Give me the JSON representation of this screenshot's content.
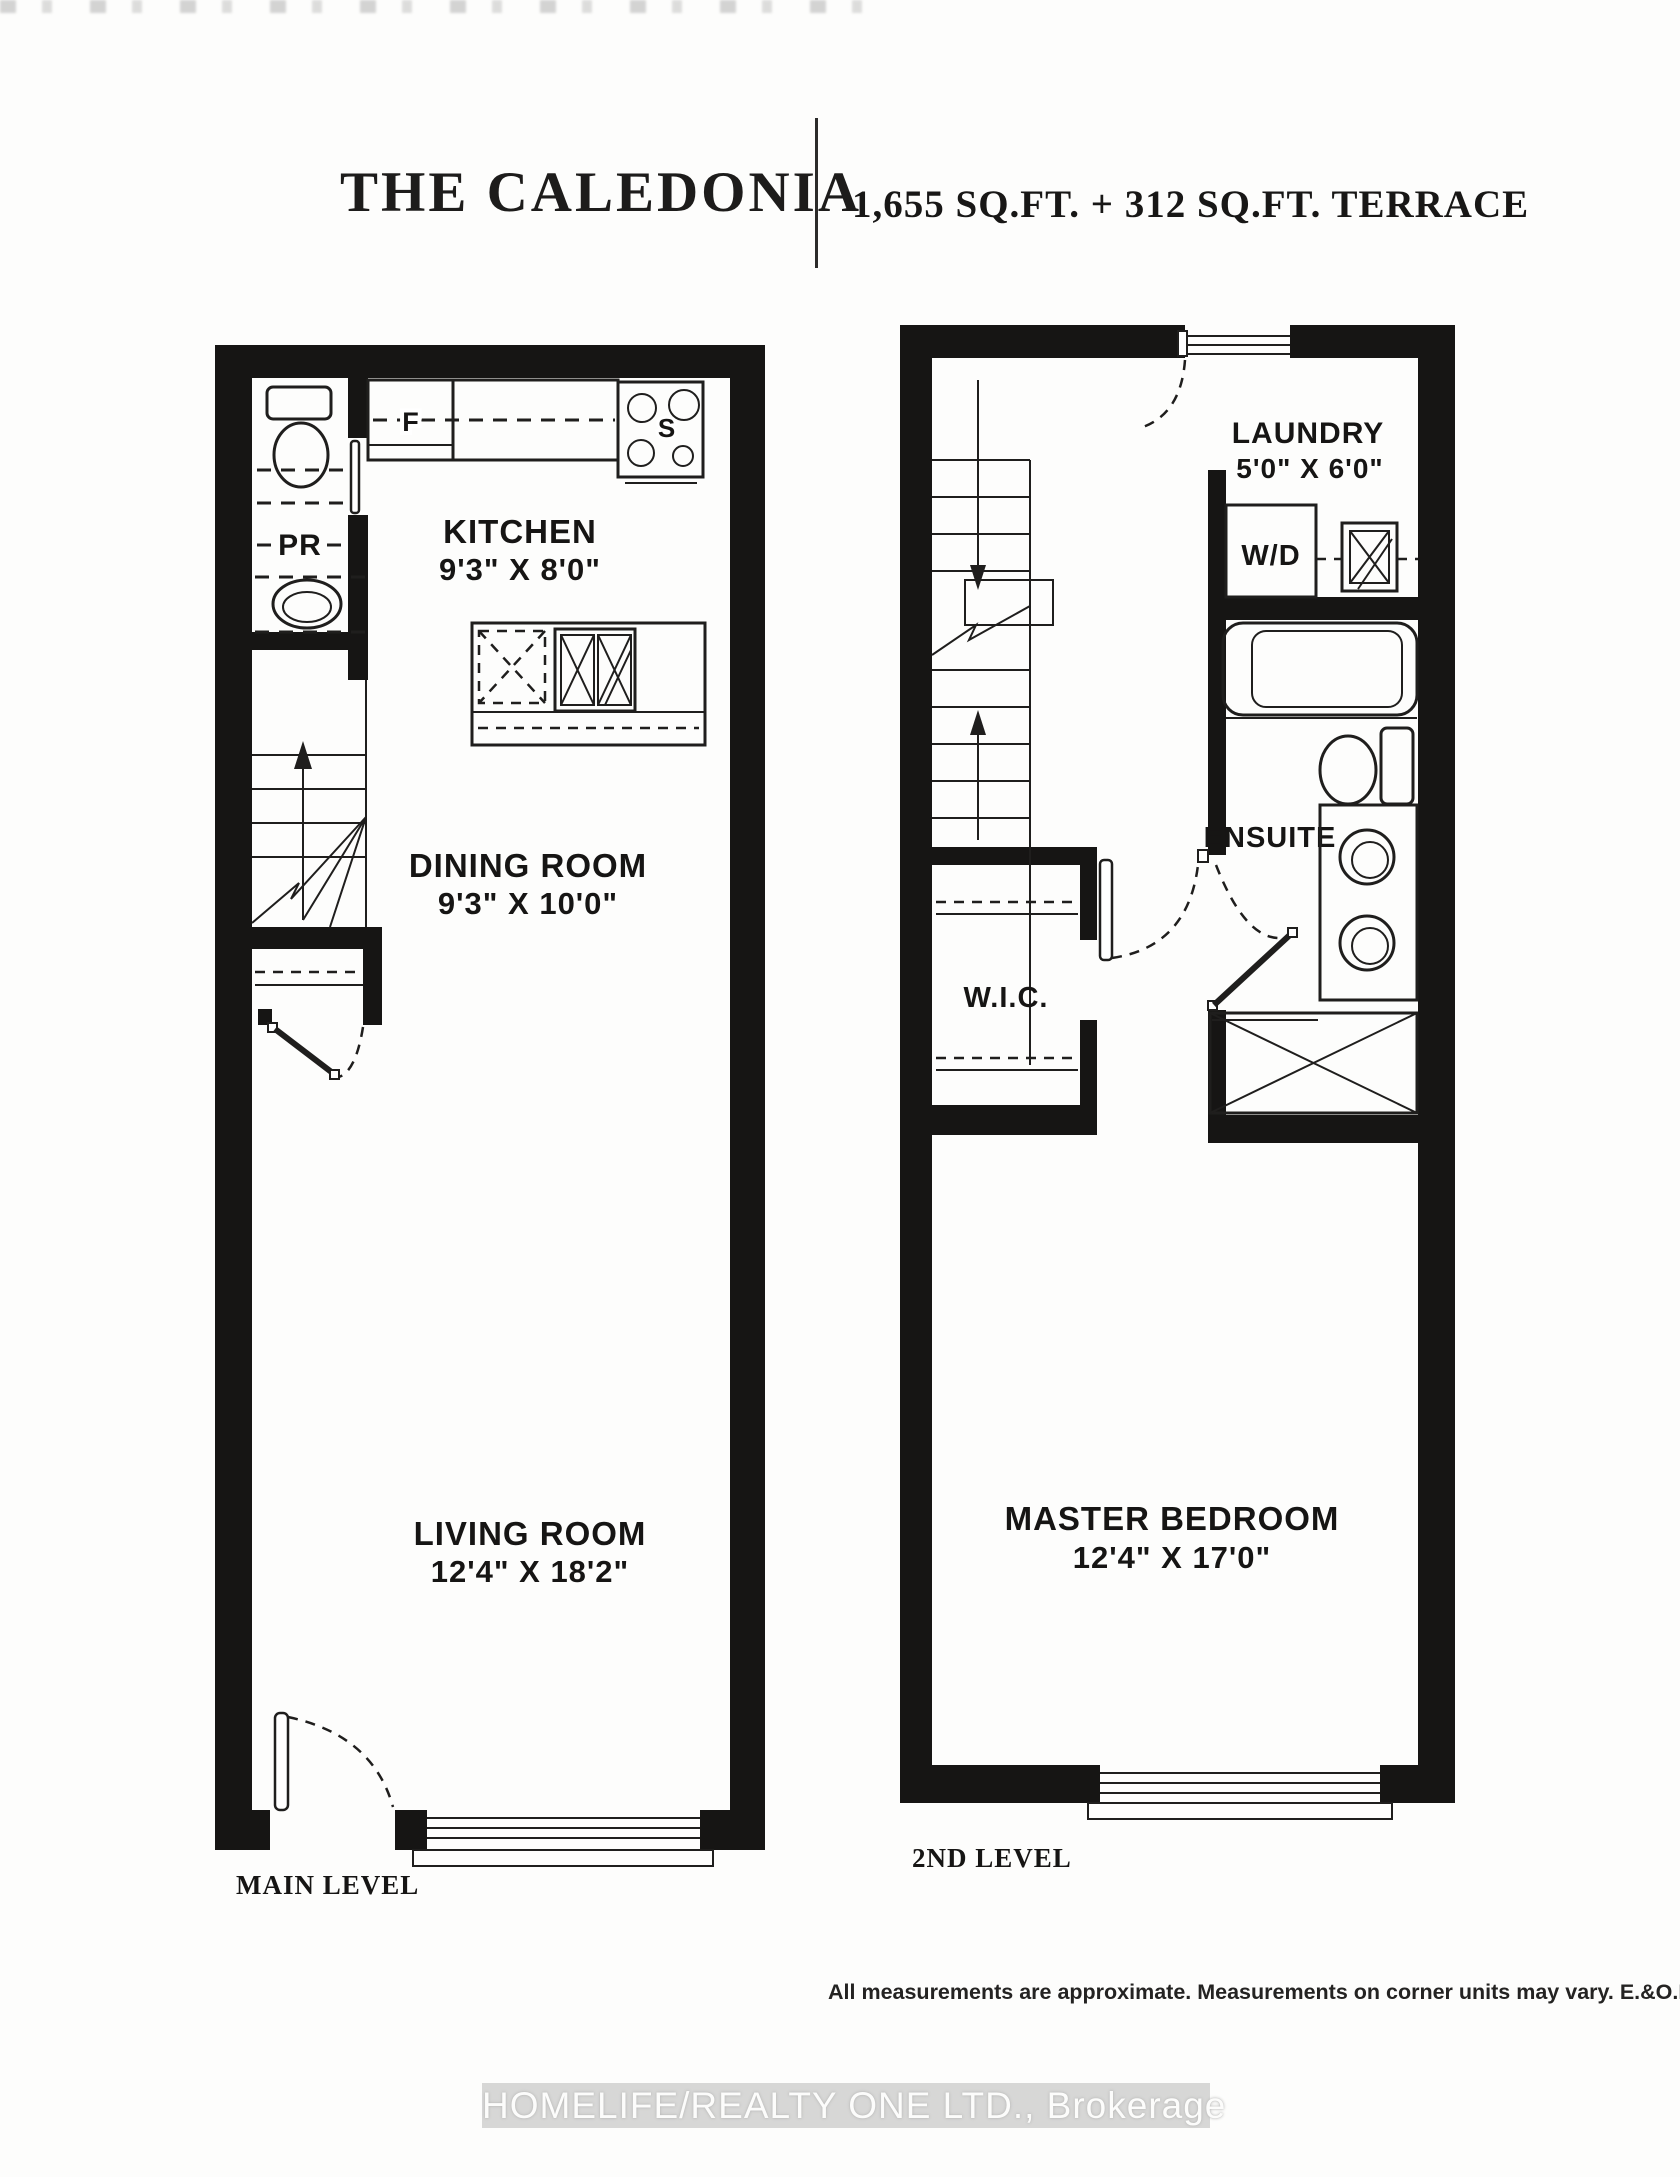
{
  "header": {
    "title": "THE CALEDONIA",
    "area_text": "1,655 SQ.FT. + 312 SQ.FT. TERRACE"
  },
  "main_level": {
    "level_label": "MAIN LEVEL",
    "rooms": {
      "kitchen": {
        "name": "KITCHEN",
        "dims": "9'3\" X 8'0\""
      },
      "dining": {
        "name": "DINING ROOM",
        "dims": "9'3\" X 10'0\""
      },
      "living": {
        "name": "LIVING ROOM",
        "dims": "12'4\" X 18'2\""
      },
      "powder": {
        "label": "PR"
      }
    },
    "fixtures": {
      "fridge_label": "F",
      "stove_label": "S"
    }
  },
  "second_level": {
    "level_label": "2ND LEVEL",
    "rooms": {
      "laundry": {
        "name": "LAUNDRY",
        "dims": "5'0\" X 6'0\""
      },
      "ensuite": {
        "name": "ENSUITE"
      },
      "wic": {
        "label": "W.I.C."
      },
      "master": {
        "name": "MASTER BEDROOM",
        "dims": "12'4\" X 17'0\""
      }
    },
    "fixtures": {
      "washer_dryer_label": "W/D"
    }
  },
  "footer": {
    "disclaimer": "All measurements are approximate. Measurements on corner units may vary. E.&O.E. 2015.",
    "watermark": "HOMELIFE/REALTY ONE LTD., Brokerage"
  },
  "colors": {
    "wall": "#161514",
    "line": "#1f1e1d",
    "watermark_bg": "#d7d7d6",
    "paper": "#fdfdfc"
  }
}
